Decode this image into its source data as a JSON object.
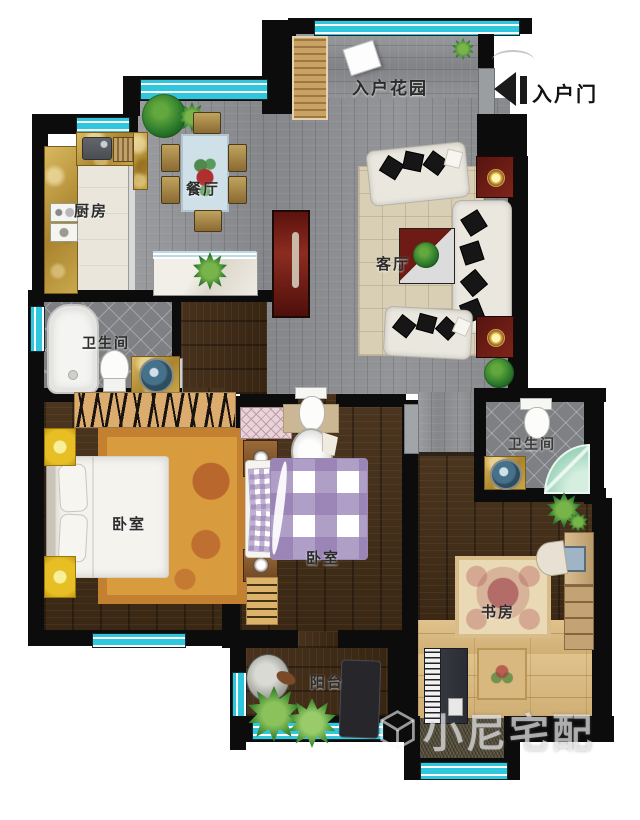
{
  "floorplan": {
    "rooms": [
      {
        "id": "entry-garden",
        "label": "入户花园"
      },
      {
        "id": "kitchen",
        "label": "厨房"
      },
      {
        "id": "dining-room",
        "label": "餐厅"
      },
      {
        "id": "living-room",
        "label": "客厅"
      },
      {
        "id": "bathroom-left",
        "label": "卫生间"
      },
      {
        "id": "bedroom-master",
        "label": "卧室"
      },
      {
        "id": "bedroom-second",
        "label": "卧室"
      },
      {
        "id": "bathroom-right",
        "label": "卫生间"
      },
      {
        "id": "study",
        "label": "书房"
      },
      {
        "id": "balcony",
        "label": "阳台"
      }
    ],
    "entry_door": {
      "label": "入户门",
      "icon": "arrow-left-icon"
    },
    "watermark": {
      "text": "小尼宅配",
      "logo_icon": "cube-wireframe-icon"
    },
    "colors": {
      "wall": "#0c0c0c",
      "window": "#35ccdf",
      "floor_gray": "#8f9193",
      "floor_dark_wood": "#44301b",
      "floor_tile": "#7e8083",
      "floor_tatami": "#d8b87f",
      "accent_red": "#6e1a15",
      "rug_orange": "#d89b3e",
      "bed_check_purple": "#947db2"
    }
  }
}
